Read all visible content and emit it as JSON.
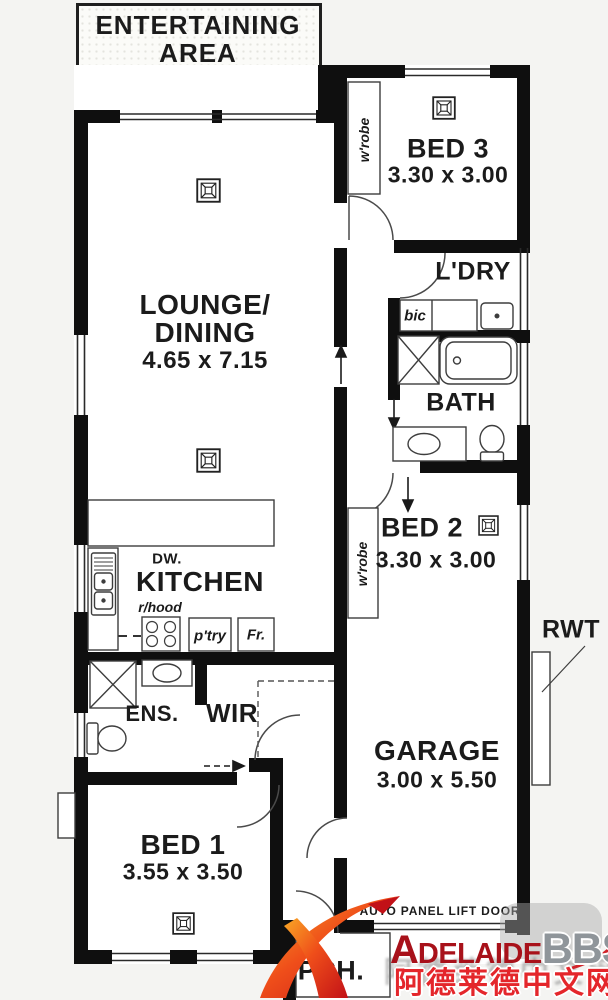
{
  "plan": {
    "entertaining": {
      "line1": "ENTERTAINING",
      "line2": "AREA"
    },
    "lounge_dining": {
      "line1": "LOUNGE/",
      "line2": "DINING",
      "dims": "4.65 x 7.15"
    },
    "kitchen": {
      "name": "KITCHEN",
      "dishwasher": "DW.",
      "rangehood": "r/hood",
      "pantry": "p'try",
      "fridge": "Fr."
    },
    "bed1": {
      "name": "BED 1",
      "dims": "3.55 x 3.50"
    },
    "bed2": {
      "name": "BED 2",
      "dims": "3.30 x 3.00",
      "wardrobe": "w'robe"
    },
    "bed3": {
      "name": "BED 3",
      "dims": "3.30 x 3.00",
      "wardrobe": "w'robe"
    },
    "laundry": {
      "name": "L'DRY",
      "cupboard": "bic"
    },
    "bath": {
      "name": "BATH"
    },
    "ensuite": {
      "name": "ENS."
    },
    "wir": {
      "name": "WIR"
    },
    "garage": {
      "name": "GARAGE",
      "dims": "3.00 x 5.50",
      "door_note": "AUTO PANEL LIFT DOOR"
    },
    "porch": {
      "name": "PCH."
    },
    "rainwater_tank": {
      "label": "RWT"
    }
  },
  "watermark": {
    "brand_a": "A",
    "brand_rest": "DELAIDE",
    "brand_bbs": "BBS",
    "brand_tld": ".com",
    "chinese": "阿德莱德中文网"
  },
  "colors": {
    "wall": "#0f0f0f",
    "fixture_line": "#3d3d3d",
    "brand_red": "#a8111a",
    "brand_gray": "#8f959a",
    "chinese_red": "#e4262b",
    "swoosh_gradient_start": "#f9a825",
    "swoosh_gradient_end": "#c21117"
  }
}
